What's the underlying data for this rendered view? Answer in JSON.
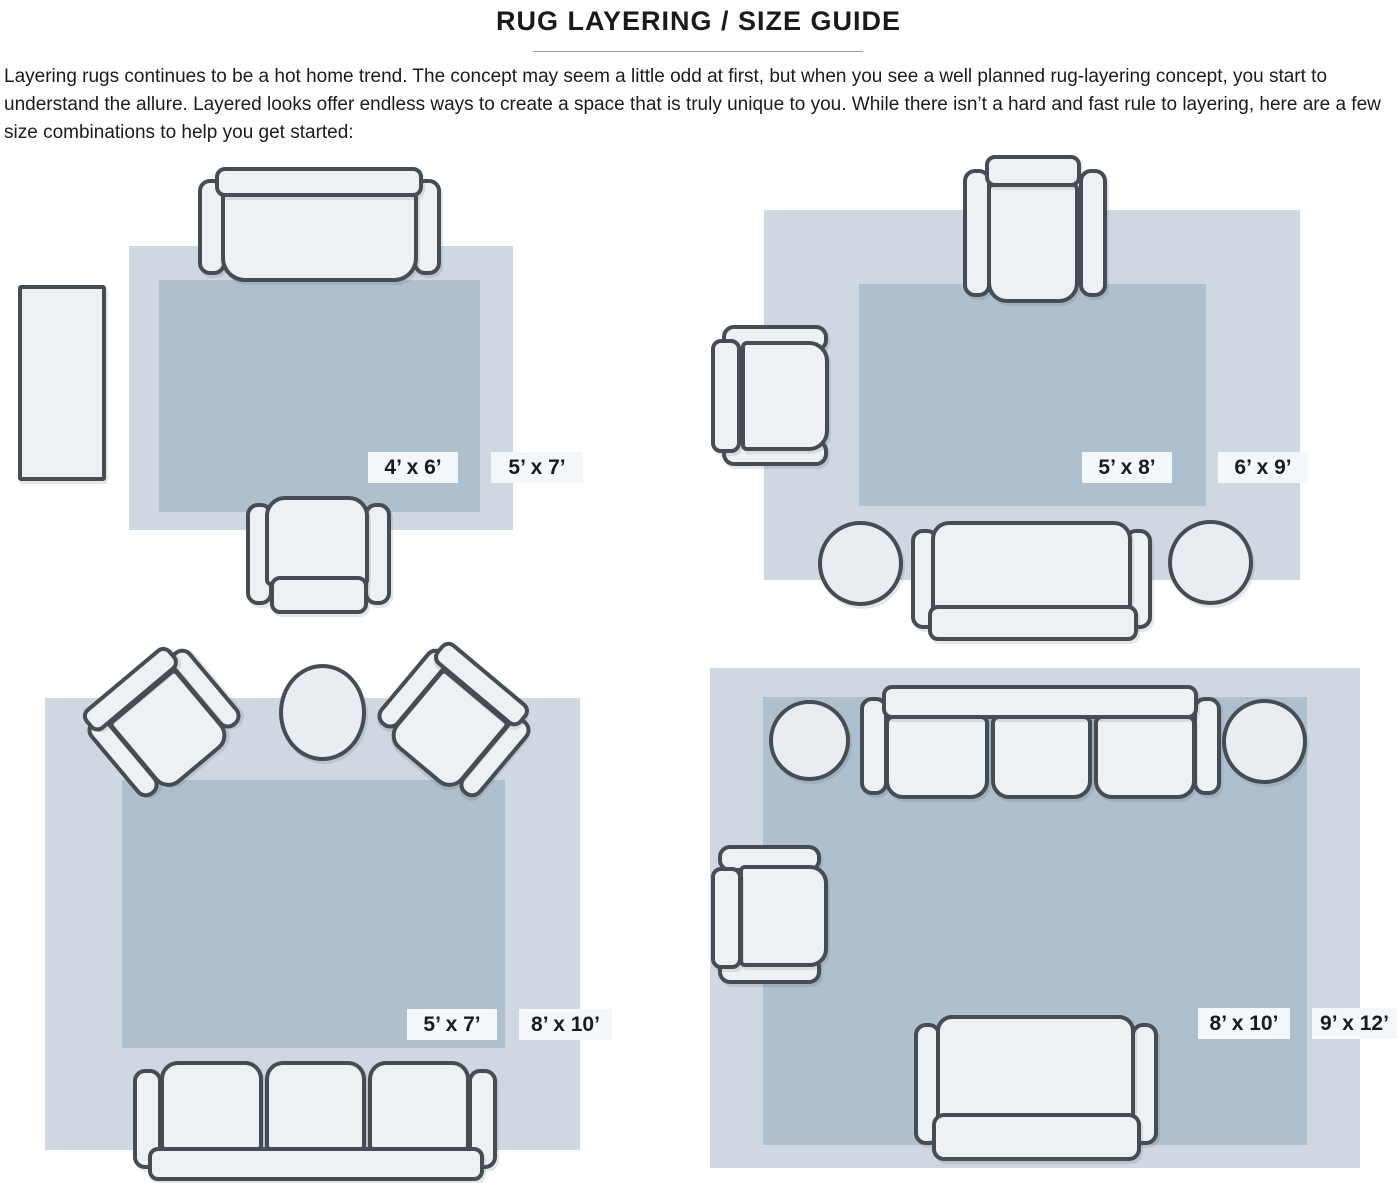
{
  "title": "RUG LAYERING / SIZE GUIDE",
  "intro": "Layering rugs continues to be a hot home trend. The concept may seem a little odd at first, but when you see a well planned rug-layering concept, you start to understand the allure. Layered looks offer endless ways to create a space that is truly unique to you. While there isn’t a hard and fast rule to layering, here are a few size combinations to help you get started:",
  "diagrams": [
    {
      "position": "top-left",
      "inner_label": "4’ x 6’",
      "outer_label": "5’ x 7’",
      "furniture": [
        "sofa",
        "armchair",
        "console-table"
      ]
    },
    {
      "position": "top-right",
      "inner_label": "5’ x 8’",
      "outer_label": "6’ x 9’",
      "furniture": [
        "armchair",
        "armchair",
        "sofa",
        "pouf",
        "pouf"
      ]
    },
    {
      "position": "bottom-left",
      "inner_label": "5’ x 7’",
      "outer_label": "8’ x 10’",
      "furniture": [
        "armchair",
        "armchair",
        "round-table",
        "three-seat-sofa"
      ]
    },
    {
      "position": "bottom-right",
      "inner_label": "8’ x 10’",
      "outer_label": "9’ x 12’",
      "furniture": [
        "three-seat-sofa",
        "pouf",
        "pouf",
        "armchair",
        "loveseat"
      ]
    }
  ],
  "colors": {
    "outer_rug": "#cfd8e1",
    "inner_rug": "#aec0cd",
    "furniture_fill": "#eef1f4",
    "furniture_outline": "#454c53",
    "label_background": "#f4f7f9",
    "text": "#1b1b1b"
  }
}
